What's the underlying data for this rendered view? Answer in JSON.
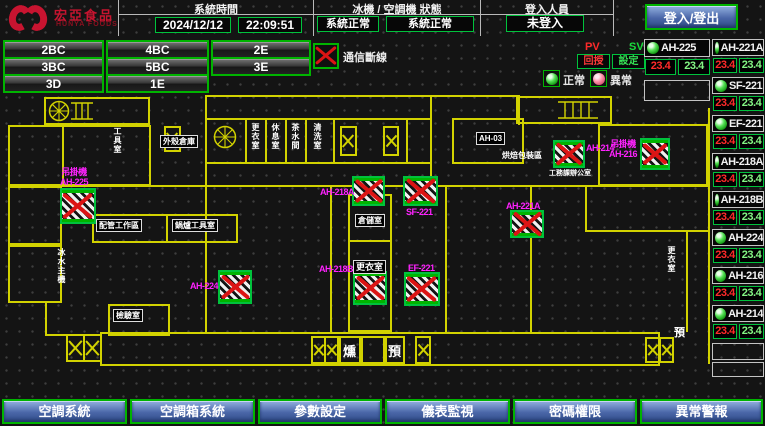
{
  "header": {
    "brand": {
      "title": "宏亞食品",
      "subtitle": "HUNYA FOODS"
    },
    "system_time": {
      "label": "系統時間",
      "date": "2024/12/12",
      "time": "22:09:51"
    },
    "machine_status": {
      "label": "冰機 / 空調機 狀態",
      "chiller": "系統正常",
      "ahu": "系統正常"
    },
    "login": {
      "label": "登入人員",
      "status": "未登入",
      "button": "登入/登出"
    }
  },
  "floor_nav": [
    "2BC",
    "4BC",
    "2E",
    "3BC",
    "5BC",
    "3E",
    "3D",
    "1E"
  ],
  "legend": {
    "comm_loss": "通信斷線",
    "pv": "PV",
    "sv": "SV",
    "pv_caption": "回授",
    "sv_caption": "設定",
    "normal": "正常",
    "abnormal": "異常"
  },
  "units": {
    "primary": {
      "name": "AH-225",
      "pv": "23.4",
      "sv": "23.4"
    },
    "list": [
      {
        "name": "AH-221A",
        "pv": "23.4",
        "sv": "23.4"
      },
      {
        "name": "SF-221",
        "pv": "23.4",
        "sv": "23.4"
      },
      {
        "name": "EF-221",
        "pv": "23.4",
        "sv": "23.4"
      },
      {
        "name": "AH-218A",
        "pv": "23.4",
        "sv": "23.4"
      },
      {
        "name": "AH-218B",
        "pv": "23.4",
        "sv": "23.4"
      },
      {
        "name": "AH-224",
        "pv": "23.4",
        "sv": "23.4"
      },
      {
        "name": "AH-216",
        "pv": "23.4",
        "sv": "23.4"
      },
      {
        "name": "AH-214",
        "pv": "23.4",
        "sv": "23.4"
      }
    ]
  },
  "map": {
    "offline_units": {
      "ah225": {
        "prefix": "吊掛機",
        "name": "AH-225"
      },
      "ah224": {
        "name": "AH-224"
      },
      "ah218a": {
        "name": "AH-218A"
      },
      "ah218b": {
        "name": "AH-218B"
      },
      "sf221": {
        "name": "SF-221"
      },
      "ef221": {
        "name": "EF-221"
      },
      "ah221a": {
        "name": "AH-221A"
      },
      "ah214": {
        "name": "AH-214"
      },
      "ah216": {
        "prefix": "吊掛機",
        "name": "AH-216"
      }
    },
    "rooms": {
      "tool": "工具室",
      "shell": "外殼倉庫",
      "v1": "更衣室",
      "v2": "休息室",
      "v3": "茶水間",
      "v4": "清洗室",
      "ahb3": "AH-03",
      "packing": "烘焙包裝區",
      "office": "工務課辦公室",
      "piping": "配管工作區",
      "boiler": "鍋爐工具室",
      "storage": "倉儲室",
      "locker_a": "更衣室",
      "locker_b": "更衣室",
      "lab": "檢驗室",
      "chiller": "冰水主機",
      "smoke": "燻",
      "pre_a": "預",
      "pre_b": "預"
    }
  },
  "bottom_nav": [
    "空調系統",
    "空調箱系統",
    "參數設定",
    "儀表監視",
    "密碼權限",
    "異常警報"
  ]
}
